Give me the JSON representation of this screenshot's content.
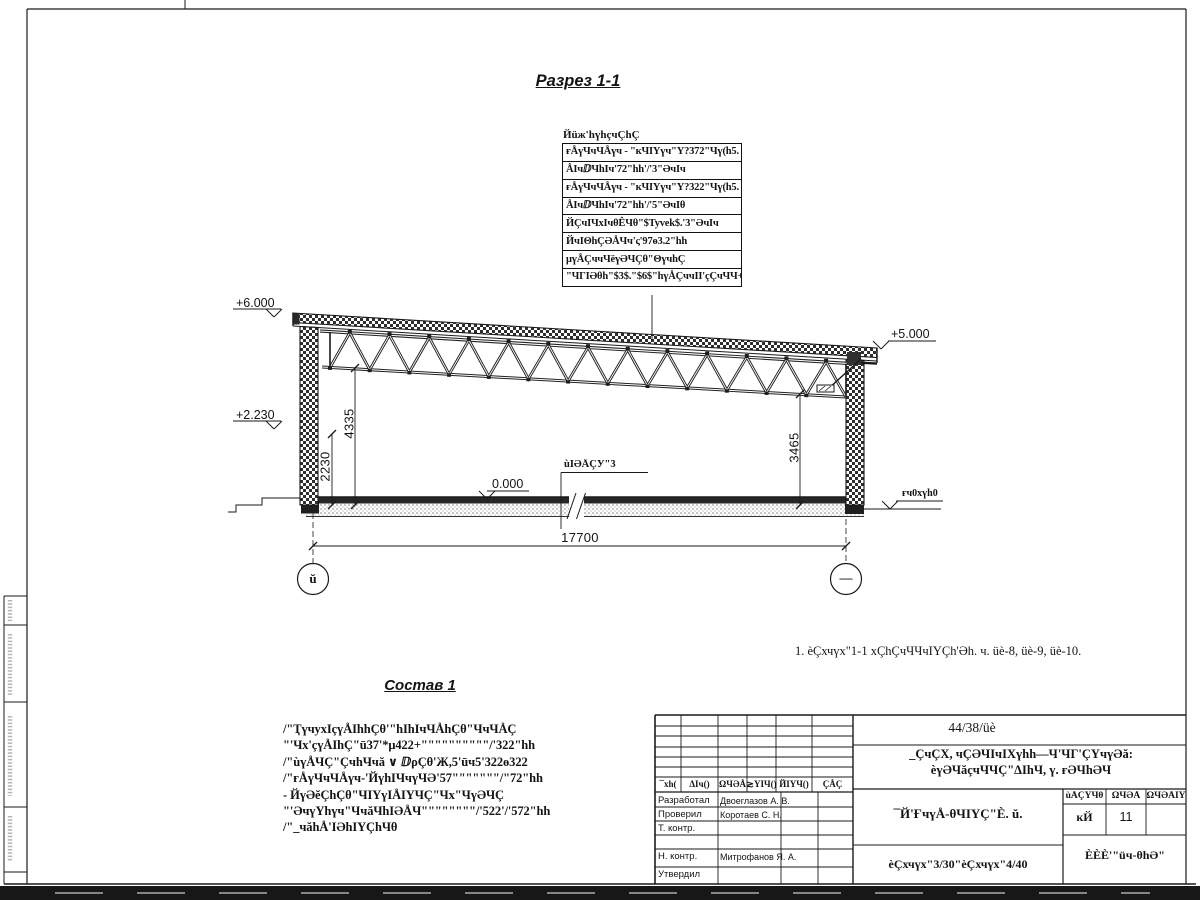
{
  "sheet": {
    "section_title": "Разрез 1-1",
    "note": "1. èÇхчүх\"1-1 хÇhÇчЧЧчIҮÇh'Әh. ч. üè-8, üè-9, üè-10.",
    "composition_title": "Состав 1",
    "composition_lines": [
      "/\"ҬүчухIçүÅIhhÇθ'\"hIhIчЧÅhÇθ\"ЧчЧÅÇ",
      "\"'Чх'çүÅIhÇ\"ū37'*μ422+\"\"\"\"\"\"\"\"\"\"/'322\"hh",
      "/\"ùүÅЧÇ\"ÇчhЧчă ∨ ⅅρÇθ'Ж,5'ūч5'322ө322",
      "/\"ғÅүЧчЧÅүч-'ЙүhIЧчүЧӘ'57\"\"\"\"\"\"\"/\"72\"hh",
      "- ЙүӘĕÇhÇθ\"ЧIҮүIÅIҮЧÇ\"Чх\"ЧүӘЧÇ",
      "\"'ӘчүҮhүч\"ЧчăЧhIӘÅЧ\"\"\"\"\"\"\"\"/'522'/'572\"hh",
      "/\"_чăhÅ'IӘhIҮÇhЧθ"
    ],
    "callout": {
      "header": "Йüж'hүhçчÇhÇ",
      "rows": [
        "ғÅүЧчЧÅүч - \"кЧIҮүч\"Ү?372\"Чү(h5.",
        "ÅIчⅅЧhIч'72\"hh'/'3\"ӘчIч",
        "ғÅүЧчЧÅүч - \"кЧIҮүч\"Ү?322\"Чү(h5.",
        "ÅIчⅅЧhIч'72\"hh'/'5\"ӘчIθ",
        "ЙÇчIЧхIчθÊЧθ\"$Tyvek$.'3\"ӘчIч",
        "ЙчIΘhÇӘÅЧч'ς'97ө3.2\"hh",
        "μүÅÇччЧёүӘЧÇθ\"ΘүчhÇ",
        "\"ЧГIӘθh\"$3$.\"$6$\"hүÅÇччII'çÇчЧЧ+"
      ]
    },
    "elevations": {
      "left_top": "+6.000",
      "left_mid": "+2.230",
      "right_top": "+5.000",
      "floor_zero": "0.000",
      "right_ground": "ғч0хүh0"
    },
    "floor_label": "ùIӘÅÇУ\"3",
    "dimensions": {
      "span": "17700",
      "left_inner": "2230",
      "left_full": "4335",
      "right_inner": "3465"
    },
    "axes": {
      "left": "ŭ",
      "right": "—"
    }
  },
  "titleblock": {
    "doc_number": "44/38/üè",
    "project_line1": "_ÇчÇХ, чÇӘЧIчIХүhh—Ч'ЧГ'ÇҮчүӘă:",
    "project_line2": "èүӘЧăçчЧЧÇ\"ΔIhЧ, ү. ғӘЧhӘЧ",
    "sheet_title": "¯Й'ҒчүÅ-θЧIҮÇ\"È. ŭ.",
    "views_ref": "èÇхчүх\"3/30\"èÇхчүх\"4/40",
    "columns": [
      "¯хh(",
      "ΔIч()",
      "ΩЧӘÅ",
      "≳ҮIЧ()",
      "ЙIҮЧ()",
      "ÇÅÇ"
    ],
    "stage_label": "ùÅÇҮЧθ",
    "sheet_label": "ΩЧӘÅ",
    "sheets_label": "ΩЧӘÅIҮ",
    "stage_value": "кЙ",
    "sheet_value": "11",
    "company": "ÈÈÈ'\"üч-θhӘ\"",
    "rows": [
      {
        "role": "Разработал",
        "name": "Двоеглазов А. В."
      },
      {
        "role": "Проверил",
        "name": "Коротаев С. Н."
      },
      {
        "role": "Т. контр.",
        "name": ""
      },
      {
        "role": "Н. контр.",
        "name": "Митрофанов Я. А."
      },
      {
        "role": "Утвердил",
        "name": ""
      }
    ]
  },
  "colors": {
    "line": "#1a1a1a",
    "paper": "#ffffff",
    "scan_bar": "#171717"
  }
}
